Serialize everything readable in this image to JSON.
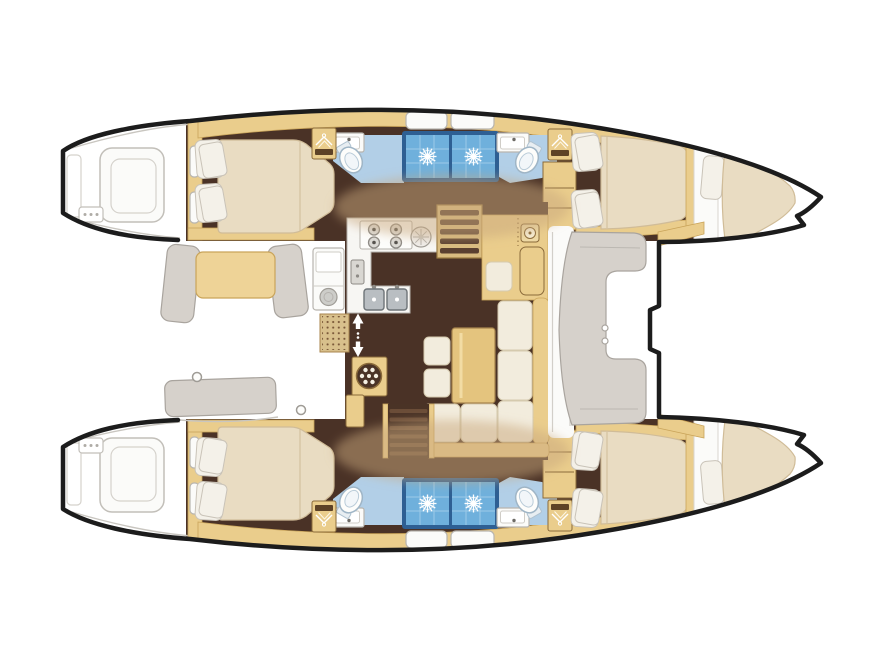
{
  "meta": {
    "title": "Catamaran yacht interior layout — top-down floor plan (4 double cabins, 2 forepeak berths, saloon and galley on bridgedeck)",
    "orientation": "bow pointing right, stern with transom steps on the left"
  },
  "palette": {
    "outline": "#1c1c1c",
    "deck_white": "#fbfbf9",
    "wood_trim": "#eacd8c",
    "wood_dark": "#c9a45a",
    "wood_border": "#8a6a3a",
    "floor_dark": "#4a3226",
    "bed_cream": "#e9dcc2",
    "bed_shadow": "#d0bc98",
    "pillow_white": "#f4f1e9",
    "upholstery_cream": "#f2ecdd",
    "gray_furniture": "#d6d1cb",
    "gray_border": "#a9a49e",
    "bath_floor_blue": "#b2cfe7",
    "shower_tile_blue": "#6fb0dc",
    "shower_frame_blue": "#2e5f93",
    "steel_gray": "#b9bec2",
    "mat_tan": "#d8c08c",
    "shadow_tint": "rgba(201,168,126,0.5)"
  },
  "boat": {
    "type": "catamaran floor plan",
    "port_hull_rooms": [
      "aft double cabin",
      "aft bathroom with toilet and shower",
      "forward bathroom with toilet and shower",
      "forward double cabin",
      "forepeak berth in bow"
    ],
    "starboard_hull_rooms": [
      "aft double cabin",
      "aft bathroom with toilet and shower",
      "forward bathroom with toilet and shower",
      "forward double cabin",
      "forepeak berth in bow"
    ],
    "bridgedeck_rooms": [
      "aft cockpit with bench seats and table",
      "galley with stove and double sink",
      "chart table / nav station",
      "L-shaped saloon sofa with table and stools",
      "companionway stairs to each hull",
      "forward cockpit seat",
      "foredeck between bows"
    ]
  },
  "icons": [
    {
      "name": "shower-drain-sun-icon",
      "meaning": "shower stall floor drain drawn as sunburst",
      "count": 4
    },
    {
      "name": "toilet-icon",
      "count": 4
    },
    {
      "name": "washbasin-icon",
      "count": 4
    },
    {
      "name": "wardrobe-hangers-icon",
      "count": 4
    },
    {
      "name": "stove-burners-icon",
      "count": 1
    },
    {
      "name": "round-sink-icon",
      "count": 1
    },
    {
      "name": "double-sink-icon",
      "count": 1
    },
    {
      "name": "galley-appliance-icon",
      "count": 1
    },
    {
      "name": "washing-machine-icon",
      "count": 1
    },
    {
      "name": "companionway-stairs-icon",
      "count": 2
    },
    {
      "name": "up-down-arrows-icon",
      "count": 1
    },
    {
      "name": "nav-instrument-icon",
      "count": 1
    },
    {
      "name": "cup-holder-ring-icon",
      "count": 2
    },
    {
      "name": "transom-drain-dots-icon",
      "count": 2
    }
  ]
}
